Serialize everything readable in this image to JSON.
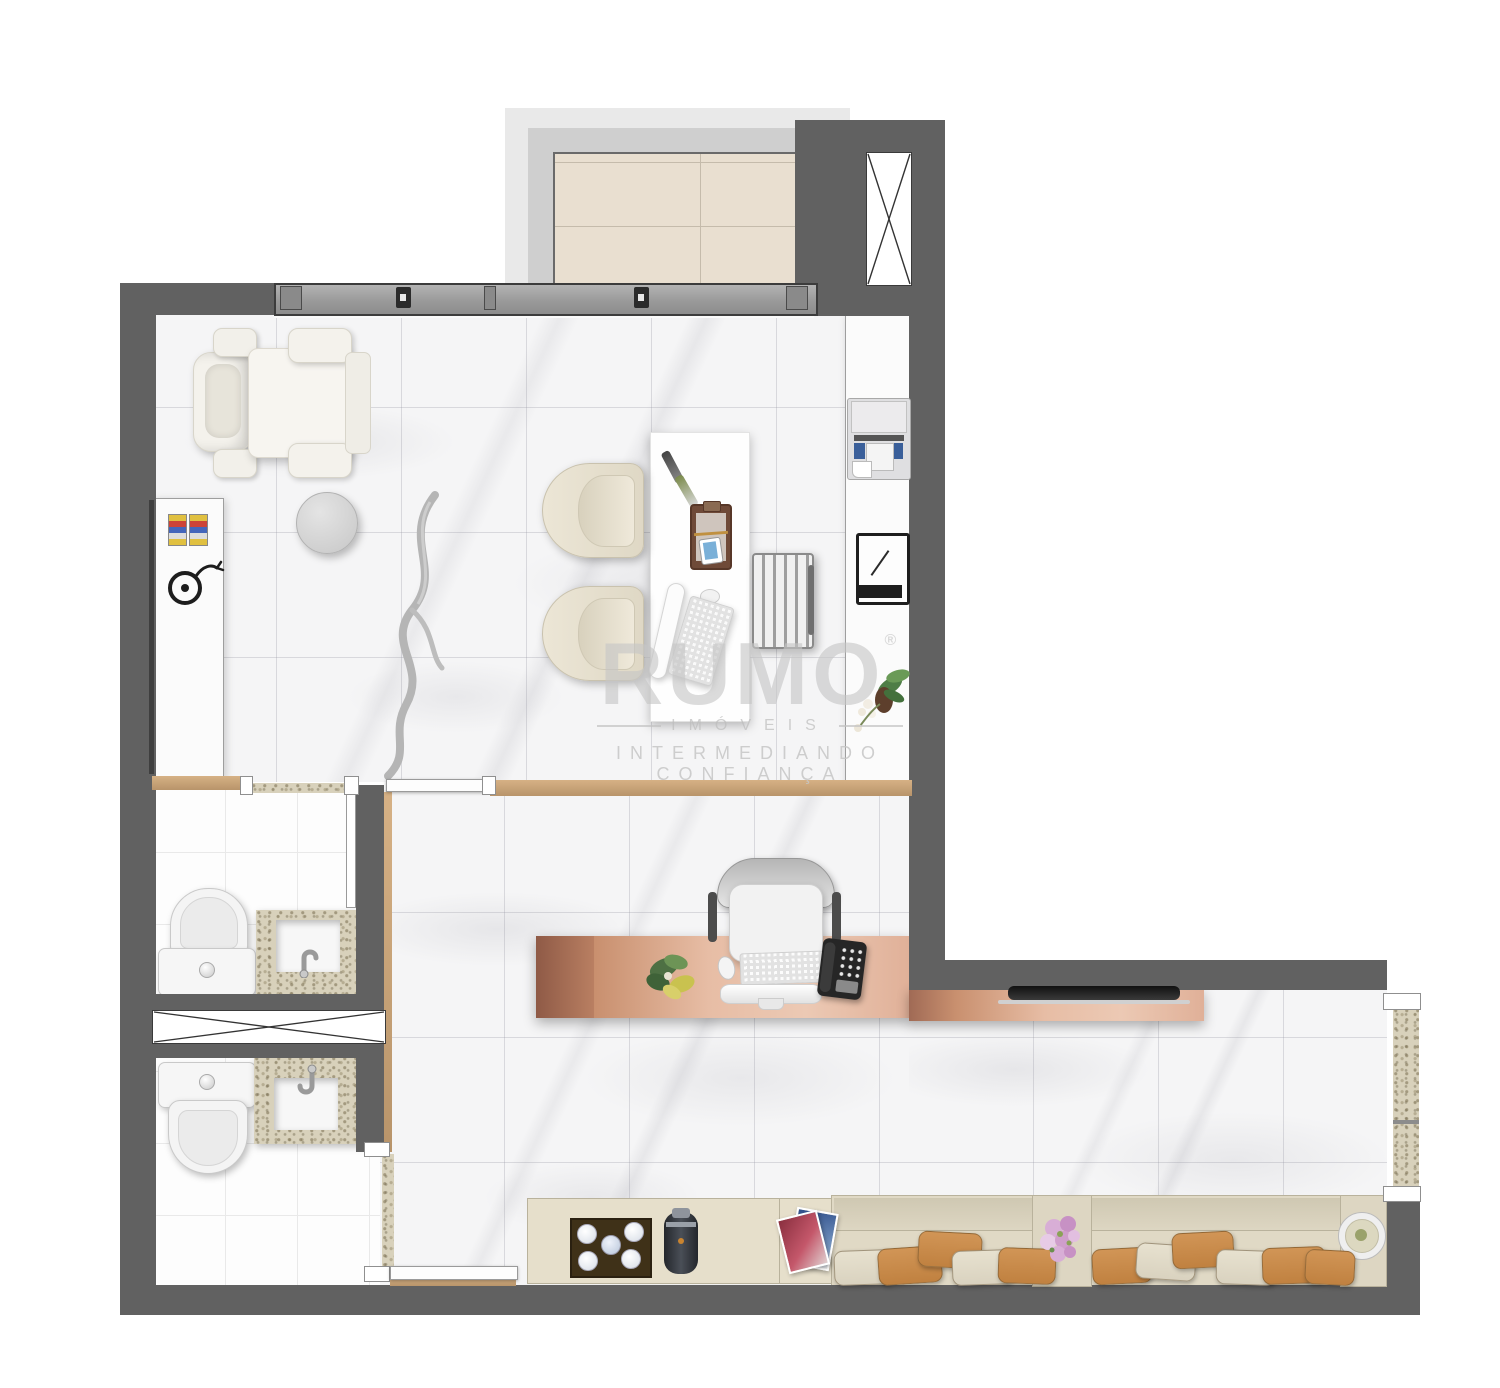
{
  "watermark": {
    "brand": "RUMO",
    "registered": "®",
    "division": "IMÓVEIS",
    "tagline": "INTERMEDIANDO CONFIANÇA"
  },
  "colors": {
    "wall": "#616161",
    "marble": "#f5f5f6",
    "balcony_tile": "#e9dfd0",
    "wood": "#c8a478",
    "granite": "#d8d1bb",
    "copper": "#c98e71",
    "counter": "#fbfbfb",
    "bench": "#ded7c3",
    "pillow_tan": "#c08140",
    "pillow_cream": "#d9d2bf",
    "watermark_gray": "#c6c6c6"
  }
}
